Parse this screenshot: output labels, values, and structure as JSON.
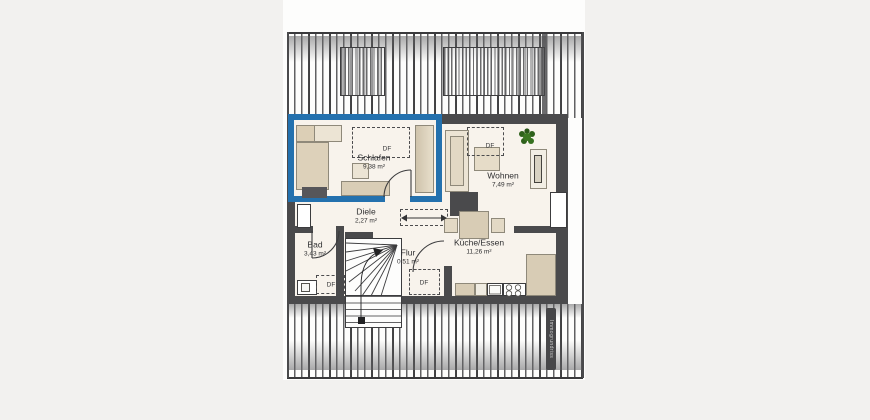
{
  "plan": {
    "rooms": [
      {
        "name": "Schlafen",
        "area": "9,38 m²"
      },
      {
        "name": "Wohnen",
        "area": "7,49 m²"
      },
      {
        "name": "Diele",
        "area": "2,27 m²"
      },
      {
        "name": "Bad",
        "area": "3,43 m²"
      },
      {
        "name": "Flur",
        "area": "0,51 m²"
      },
      {
        "name": "Küche/Essen",
        "area": "11,26 m²"
      }
    ],
    "df_label": "DF",
    "watermark": "Immogrundriss",
    "colors": {
      "highlight_blue": "#2471ae",
      "wall_gray": "#4a4a4c",
      "floor_cream": "#f8f3ec",
      "furniture_beige": "#ddd1ba",
      "plant_green": "#35701f",
      "background": "#f2f1ef"
    }
  }
}
